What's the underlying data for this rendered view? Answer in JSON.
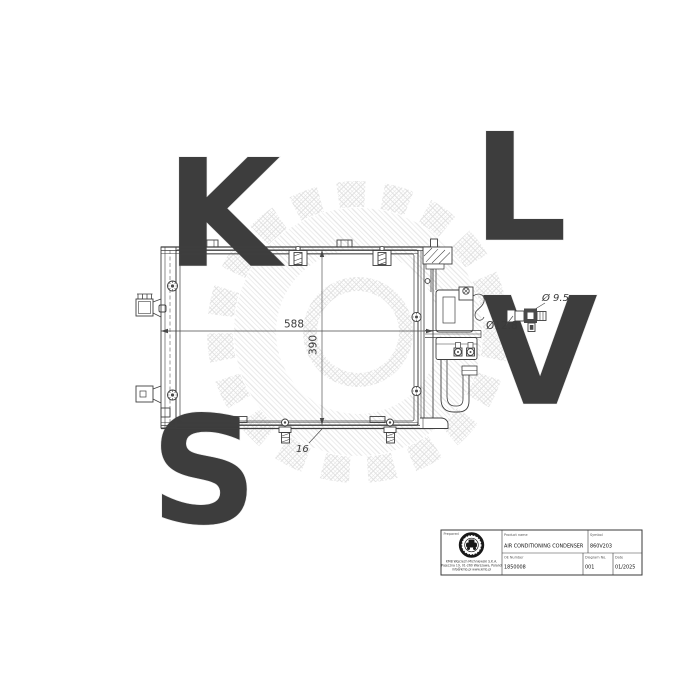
{
  "drawing": {
    "dim_width": "588",
    "dim_height": "390",
    "dim_depth": "16",
    "dim_port_small": "Ø 9.5",
    "dim_port_large": "Ø12.8"
  },
  "title_block": {
    "prepared_label": "Prepared",
    "product_label": "Product name",
    "product_value": "AIR CONDITIONING CONDENSER",
    "symbol_label": "Symbol",
    "symbol_value": "860V203",
    "oe_label": "OE Number",
    "oe_value": "1850008",
    "diagram_label": "Diagram No.",
    "diagram_value": "001",
    "date_label": "Date",
    "date_value": "01/2025",
    "company_line1": "KMB Wojciech Michniewski S.K.A.",
    "company_line2": "Pajeczna 19, 01-260 Warszawa, Poland",
    "company_line3": "info@kmb.pl   www.kmb.pl"
  },
  "watermark": {
    "letters": [
      "S",
      "K",
      "V",
      "L"
    ],
    "color": "#e3e3e3"
  },
  "colors": {
    "line": "#3f3f3f",
    "dim": "#4a4a4a",
    "dark_fill": "#4a4a4a",
    "watermark": "#e3e3e3"
  }
}
